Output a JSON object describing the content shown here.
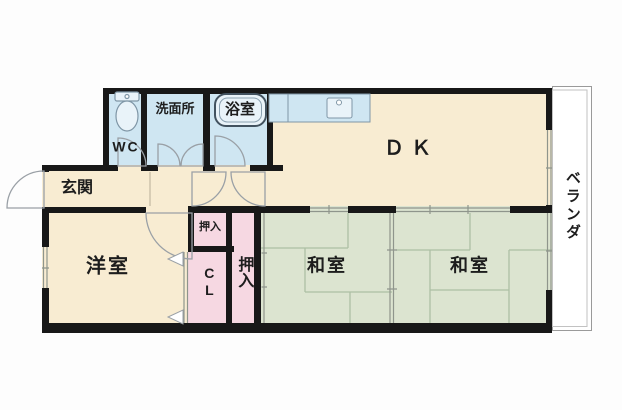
{
  "title": "apartment-floor-plan",
  "colors": {
    "floor_cream": "#f8ecd2",
    "water_blue": "#cfe6f2",
    "water_blue_light": "#e9f3f9",
    "closet_pink": "#f6d8e2",
    "tatami_green": "#dce4d0",
    "tatami_line": "#adbfa4",
    "wall_black": "#181818",
    "door_line": "#9aa0a6",
    "veranda_line": "#9a9a9a",
    "veranda_fill": "#ffffff"
  },
  "rooms": {
    "dk": "ＤＫ",
    "entrance": "玄関",
    "wc": "WC",
    "washroom": "洗面所",
    "bathroom": "浴室",
    "western_room": "洋室",
    "closet_upper": "押入",
    "closet_cl": "CL",
    "closet_main": "押入",
    "japanese_room_left": "和室",
    "japanese_room_right": "和室",
    "veranda": "ベランダ"
  }
}
